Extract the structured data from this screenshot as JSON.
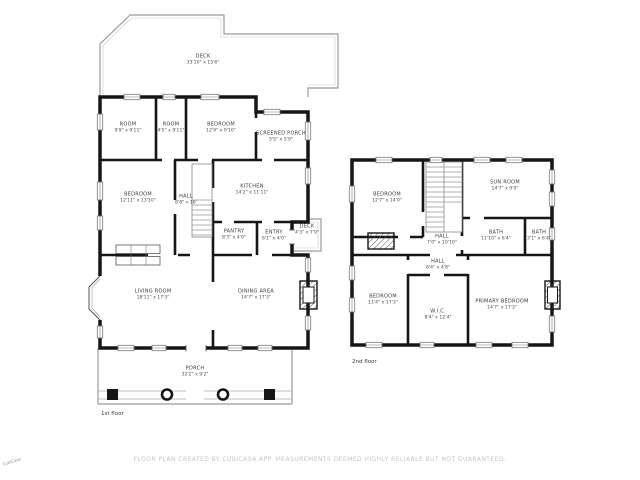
{
  "disclaimer": "FLOOR PLAN CREATED BY CUBICASA APP. MEASUREMENTS DEEMED HIGHLY RELIABLE BUT NOT GUARANTEED.",
  "watermark": "CubiCasa",
  "floor1": {
    "label": "1st floor",
    "rooms": [
      {
        "name": "DECK",
        "dims": "33'10\" x 15'6\""
      },
      {
        "name": "ROOM",
        "dims": "9'9\" x 9'11\""
      },
      {
        "name": "ROOM",
        "dims": "4'5\" x 9'11\""
      },
      {
        "name": "BEDROOM",
        "dims": "12'9\" x 9'10\""
      },
      {
        "name": "SCREENED PORCH",
        "dims": "5'5\" x 5'9\""
      },
      {
        "name": "BEDROOM",
        "dims": "12'11\" x 13'10\""
      },
      {
        "name": "HALL",
        "dims": "8'8\" x 16'"
      },
      {
        "name": "KITCHEN",
        "dims": "14'2\" x 11'11\""
      },
      {
        "name": "PANTRY",
        "dims": "8'3\" x 4'0\""
      },
      {
        "name": "ENTRY",
        "dims": "6'1\" x 4'0\""
      },
      {
        "name": "DECK",
        "dims": "4'3\" x 7'9\""
      },
      {
        "name": "LIVING ROOM",
        "dims": "18'11\" x 17'3\""
      },
      {
        "name": "DINING AREA",
        "dims": "14'7\" x 17'3\""
      },
      {
        "name": "PORCH",
        "dims": "32'2\" x 9'2\""
      }
    ]
  },
  "floor2": {
    "label": "2nd floor",
    "rooms": [
      {
        "name": "BEDROOM",
        "dims": "12'7\" x 14'0\""
      },
      {
        "name": "SUN ROOM",
        "dims": "14'7\" x 9'9\""
      },
      {
        "name": "HALL",
        "dims": "7'0\" x 10'10\""
      },
      {
        "name": "BATH",
        "dims": "11'10\" x 6'4\""
      },
      {
        "name": "BATH",
        "dims": "3'1\" x 6'4\""
      },
      {
        "name": "HALL",
        "dims": "8'4\" x 4'8\""
      },
      {
        "name": "BEDROOM",
        "dims": "11'4\" x 17'3\""
      },
      {
        "name": "W.I.C.",
        "dims": "8'4\" x 12'4\""
      },
      {
        "name": "PRIMARY BEDROOM",
        "dims": "14'7\" x 17'3\""
      }
    ]
  },
  "colors": {
    "wall": "#161616",
    "thin_line": "#9a9a9a",
    "label_text": "#3a3a3a",
    "disclaimer_text": "#c6c6c6"
  }
}
